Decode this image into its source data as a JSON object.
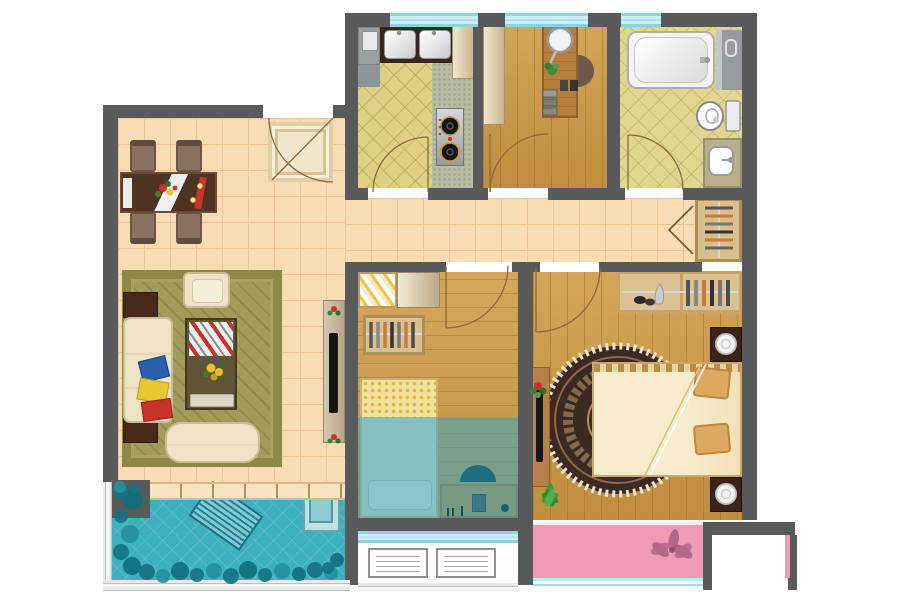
{
  "scene": {
    "kind": "residential-floor-plan",
    "view": "top-down",
    "width_px": 900,
    "height_px": 600
  },
  "palette": {
    "wall": "#58595b",
    "tile_cream": "#f8ddb4",
    "tile_line": "#efc392",
    "wood_floor": "#cf9a44",
    "kitchen_tile": "#ded183",
    "bath_tile": "#e0d68f",
    "counter_speckle": "#b6bda4",
    "balcony_teal": "#3db0c0",
    "plant_teal": "#157282",
    "blue_wash_overlay": "rgba(56,166,196,0.52)",
    "bay_pink": "#f09ab8",
    "window_cyan": "#cdeef5",
    "rug_olive": "#a29c5a",
    "round_rug_dark": "#3c2a22",
    "rug_fringe": "#ece5d4",
    "sofa_cream": "#ece4c4",
    "bed_cream": "#f4ead0",
    "duvet_yellow": "#ecd26a",
    "pillow_tan": "#dca960",
    "furniture_dark_brown": "#46291a",
    "desk_wood": "#b5803c",
    "door_arc": "#8a6a42",
    "closet_fold": "#6b5336",
    "fixture_white": "#f4f4f4",
    "fixture_line": "#9a9a9a",
    "accent_red": "#c8342c",
    "accent_blue": "#2b5fae",
    "accent_yellow": "#e8c832"
  },
  "rooms": [
    {
      "id": "dining-area",
      "floor": "cream-tile",
      "furniture": [
        "dining-table",
        "dining-chair x4",
        "entry-doormat",
        "table-runner",
        "flower-centerpiece"
      ]
    },
    {
      "id": "kitchen",
      "floor": "diagonal-lattice-tile",
      "furniture": [
        "fridge-unit",
        "double-sink",
        "sink-counter",
        "side-counter",
        "gas-stove-2-burner",
        "tall-cabinet"
      ]
    },
    {
      "id": "study",
      "floor": "wood-plank",
      "furniture": [
        "tall-cabinet",
        "desk",
        "desk-chair",
        "desk-mirror",
        "potted-plant",
        "book-stacks"
      ]
    },
    {
      "id": "bathroom",
      "floor": "diagonal-lattice-tile",
      "furniture": [
        "bathtub",
        "shower-partition",
        "toilet",
        "washbasin-counter"
      ]
    },
    {
      "id": "hallway",
      "floor": "cream-tile",
      "furniture": [
        "hall-closet-with-hangers",
        "bifold-door"
      ]
    },
    {
      "id": "living-room",
      "floor": "cream-tile",
      "furniture": [
        "olive-area-rug",
        "armchair",
        "sofa",
        "throw-pillows x3",
        "side-table x2",
        "coffee-table",
        "magazine",
        "serving-tray",
        "bench-daybed",
        "tv-console",
        "flat-tv",
        "flower-pot x2"
      ]
    },
    {
      "id": "small-bedroom",
      "floor": "wood-plank + blue-wash",
      "furniture": [
        "striped-dresser",
        "plain-dresser",
        "wardrobe-with-hangers",
        "single-bed",
        "pillow",
        "study-desk",
        "desk-chair"
      ]
    },
    {
      "id": "master-bedroom",
      "floor": "wood-plank",
      "furniture": [
        "wardrobe-with-hangers",
        "double-bed",
        "pillow x2",
        "nightstand-with-lamp x2",
        "round-ornate-rug",
        "tv-cabinet",
        "flat-tv",
        "potted-plant",
        "floor-palm-plant"
      ]
    },
    {
      "id": "main-balcony",
      "floor": "teal-tile",
      "furniture": [
        "lounge-chair",
        "washing-machine",
        "planter-shrubs"
      ]
    },
    {
      "id": "utility-balcony",
      "floor": "white",
      "furniture": [
        "radiator-unit x2"
      ]
    },
    {
      "id": "bay-window-ledge",
      "floor": "pink",
      "furniture": [
        "flower-motif"
      ]
    }
  ],
  "doors": [
    "entry-door",
    "kitchen-door",
    "study-door",
    "bathroom-door",
    "small-bedroom-door",
    "master-bedroom-door",
    "hall-closet-bifold"
  ],
  "windows": [
    "kitchen-top-window",
    "study-top-window",
    "bathroom-top-window",
    "small-bedroom-balcony-window",
    "balcony-left-railing",
    "balcony-bottom-railing",
    "utility-balcony-railing",
    "bay-window-railing"
  ]
}
